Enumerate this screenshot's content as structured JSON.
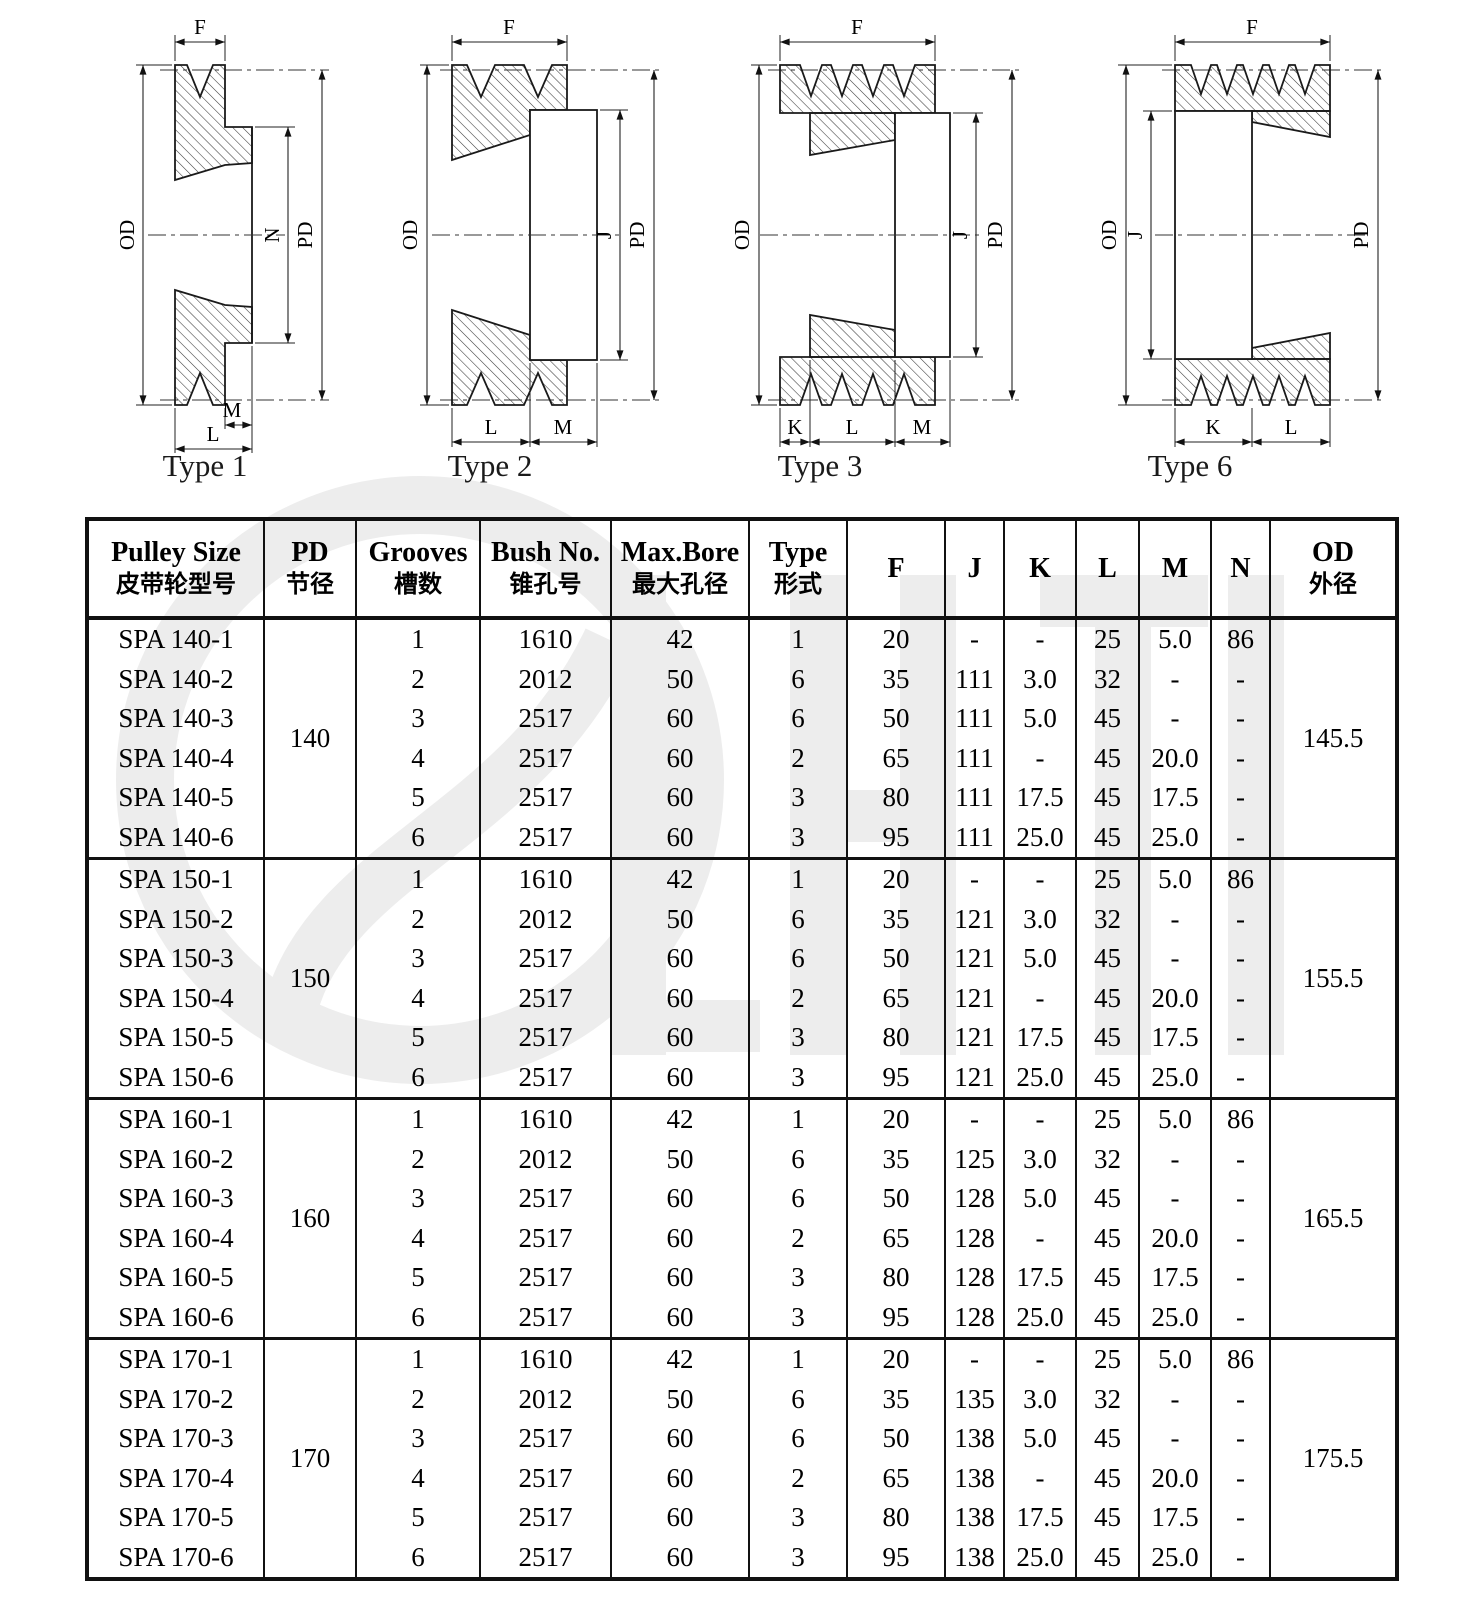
{
  "colors": {
    "ink": "#111111",
    "watermark": "#ededed"
  },
  "drawings": {
    "dim_labels": {
      "f": "F",
      "od": "OD",
      "pd": "PD",
      "j": "J",
      "n": "N",
      "k": "K",
      "l": "L",
      "m": "M"
    },
    "types": [
      {
        "caption": "Type 1"
      },
      {
        "caption": "Type 2"
      },
      {
        "caption": "Type 3"
      },
      {
        "caption": "Type 6"
      }
    ]
  },
  "table": {
    "headers": [
      {
        "en": "Pulley Size",
        "zh": "皮带轮型号"
      },
      {
        "en": "PD",
        "zh": "节径"
      },
      {
        "en": "Grooves",
        "zh": "槽数"
      },
      {
        "en": "Bush No.",
        "zh": "锥孔号"
      },
      {
        "en": "Max.Bore",
        "zh": "最大孔径"
      },
      {
        "en": "Type",
        "zh": "形式"
      },
      {
        "en": "F"
      },
      {
        "en": "J"
      },
      {
        "en": "K"
      },
      {
        "en": "L"
      },
      {
        "en": "M"
      },
      {
        "en": "N"
      },
      {
        "en": "OD",
        "zh": "外径"
      }
    ],
    "groups": [
      {
        "pd": "140",
        "od": "145.5",
        "rows": [
          [
            "SPA 140-1",
            "1",
            "1610",
            "42",
            "1",
            "20",
            "-",
            "-",
            "25",
            "5.0",
            "86"
          ],
          [
            "SPA 140-2",
            "2",
            "2012",
            "50",
            "6",
            "35",
            "111",
            "3.0",
            "32",
            "-",
            "-"
          ],
          [
            "SPA 140-3",
            "3",
            "2517",
            "60",
            "6",
            "50",
            "111",
            "5.0",
            "45",
            "-",
            "-"
          ],
          [
            "SPA 140-4",
            "4",
            "2517",
            "60",
            "2",
            "65",
            "111",
            "-",
            "45",
            "20.0",
            "-"
          ],
          [
            "SPA 140-5",
            "5",
            "2517",
            "60",
            "3",
            "80",
            "111",
            "17.5",
            "45",
            "17.5",
            "-"
          ],
          [
            "SPA 140-6",
            "6",
            "2517",
            "60",
            "3",
            "95",
            "111",
            "25.0",
            "45",
            "25.0",
            "-"
          ]
        ]
      },
      {
        "pd": "150",
        "od": "155.5",
        "rows": [
          [
            "SPA 150-1",
            "1",
            "1610",
            "42",
            "1",
            "20",
            "-",
            "-",
            "25",
            "5.0",
            "86"
          ],
          [
            "SPA 150-2",
            "2",
            "2012",
            "50",
            "6",
            "35",
            "121",
            "3.0",
            "32",
            "-",
            "-"
          ],
          [
            "SPA 150-3",
            "3",
            "2517",
            "60",
            "6",
            "50",
            "121",
            "5.0",
            "45",
            "-",
            "-"
          ],
          [
            "SPA 150-4",
            "4",
            "2517",
            "60",
            "2",
            "65",
            "121",
            "-",
            "45",
            "20.0",
            "-"
          ],
          [
            "SPA 150-5",
            "5",
            "2517",
            "60",
            "3",
            "80",
            "121",
            "17.5",
            "45",
            "17.5",
            "-"
          ],
          [
            "SPA 150-6",
            "6",
            "2517",
            "60",
            "3",
            "95",
            "121",
            "25.0",
            "45",
            "25.0",
            "-"
          ]
        ]
      },
      {
        "pd": "160",
        "od": "165.5",
        "rows": [
          [
            "SPA 160-1",
            "1",
            "1610",
            "42",
            "1",
            "20",
            "-",
            "-",
            "25",
            "5.0",
            "86"
          ],
          [
            "SPA 160-2",
            "2",
            "2012",
            "50",
            "6",
            "35",
            "125",
            "3.0",
            "32",
            "-",
            "-"
          ],
          [
            "SPA 160-3",
            "3",
            "2517",
            "60",
            "6",
            "50",
            "128",
            "5.0",
            "45",
            "-",
            "-"
          ],
          [
            "SPA 160-4",
            "4",
            "2517",
            "60",
            "2",
            "65",
            "128",
            "-",
            "45",
            "20.0",
            "-"
          ],
          [
            "SPA 160-5",
            "5",
            "2517",
            "60",
            "3",
            "80",
            "128",
            "17.5",
            "45",
            "17.5",
            "-"
          ],
          [
            "SPA 160-6",
            "6",
            "2517",
            "60",
            "3",
            "95",
            "128",
            "25.0",
            "45",
            "25.0",
            "-"
          ]
        ]
      },
      {
        "pd": "170",
        "od": "175.5",
        "rows": [
          [
            "SPA 170-1",
            "1",
            "1610",
            "42",
            "1",
            "20",
            "-",
            "-",
            "25",
            "5.0",
            "86"
          ],
          [
            "SPA 170-2",
            "2",
            "2012",
            "50",
            "6",
            "35",
            "135",
            "3.0",
            "32",
            "-",
            "-"
          ],
          [
            "SPA 170-3",
            "3",
            "2517",
            "60",
            "6",
            "50",
            "138",
            "5.0",
            "45",
            "-",
            "-"
          ],
          [
            "SPA 170-4",
            "4",
            "2517",
            "60",
            "2",
            "65",
            "138",
            "-",
            "45",
            "20.0",
            "-"
          ],
          [
            "SPA 170-5",
            "5",
            "2517",
            "60",
            "3",
            "80",
            "138",
            "17.5",
            "45",
            "17.5",
            "-"
          ],
          [
            "SPA 170-6",
            "6",
            "2517",
            "60",
            "3",
            "95",
            "138",
            "25.0",
            "45",
            "25.0",
            "-"
          ]
        ]
      }
    ]
  }
}
